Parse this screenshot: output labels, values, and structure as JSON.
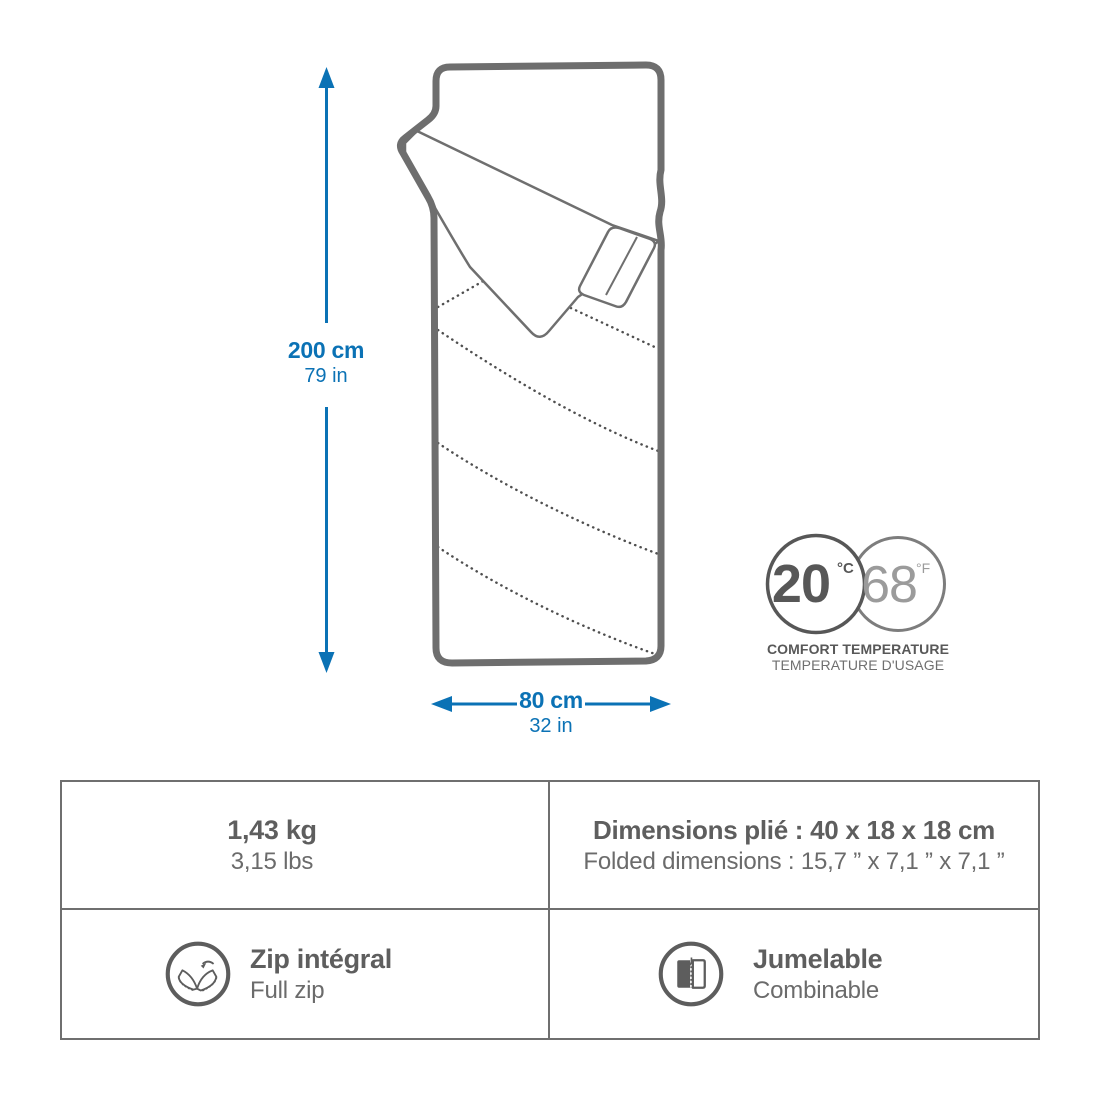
{
  "diagram": {
    "height_label": {
      "metric": "200 cm",
      "imperial": "79 in"
    },
    "width_label": {
      "metric": "80 cm",
      "imperial": "32 in"
    },
    "temperature": {
      "celsius": "20",
      "celsius_unit": "°C",
      "fahrenheit": "68",
      "fahrenheit_unit": "°F",
      "caption_line1": "COMFORT TEMPERATURE",
      "caption_line2": "TEMPERATURE D'USAGE"
    }
  },
  "specs": {
    "weight": {
      "primary": "1,43 kg",
      "secondary": "3,15 lbs"
    },
    "folded": {
      "primary": "Dimensions plié : 40 x 18 x 18 cm",
      "secondary": "Folded dimensions : 15,7 ” x 7,1 ” x 7,1 ”"
    },
    "zip": {
      "primary": "Zip intégral",
      "secondary": "Full zip"
    },
    "pairing": {
      "primary": "Jumelable",
      "secondary": "Combinable"
    }
  },
  "colors": {
    "accent_blue": "#0b72b5",
    "line_gray": "#6e6e6e",
    "text_dark": "#5e5e5e",
    "text_light": "#9b9b9b"
  }
}
